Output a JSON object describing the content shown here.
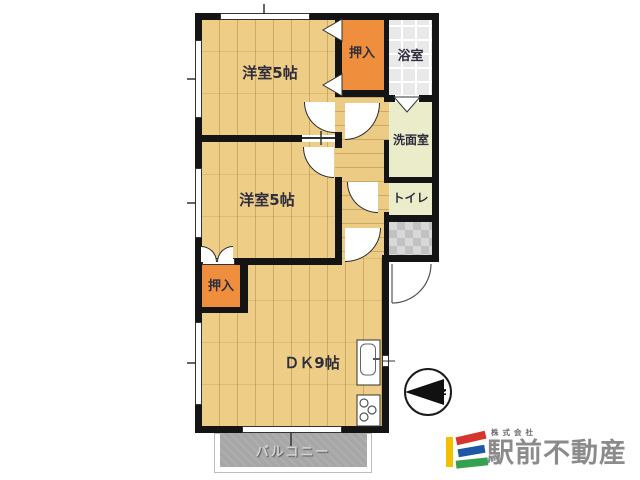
{
  "floorplan": {
    "rooms": {
      "room1": {
        "label": "洋室5帖"
      },
      "room2": {
        "label": "洋室5帖"
      },
      "dk": {
        "label": "ＤＫ9帖"
      },
      "closet1": {
        "label": "押入"
      },
      "closet2": {
        "label": "押入"
      },
      "bathroom": {
        "label": "浴室"
      },
      "washroom": {
        "label": "洗面室"
      },
      "toilet": {
        "label": "トイレ"
      },
      "balcony": {
        "label": "バルコニー"
      }
    },
    "compass": {
      "north_label": "N"
    },
    "colors": {
      "wood_floor": "#eecd86",
      "closet": "#ef8f3d",
      "bath_tile": "#e9e9e9",
      "sanitary": "#ebecc9",
      "entrance_tile": "#c9c9c9",
      "balcony_deck": "#a7a7a7",
      "wall": "#141414"
    }
  },
  "branding": {
    "company_prefix": "株式会社",
    "company_name": "駅前不動産",
    "text_color": "#8b8b8b",
    "logo_colors": {
      "yellow": "#f3c000",
      "red": "#d6342c",
      "blue": "#1f57a5",
      "green": "#35a14f"
    }
  }
}
